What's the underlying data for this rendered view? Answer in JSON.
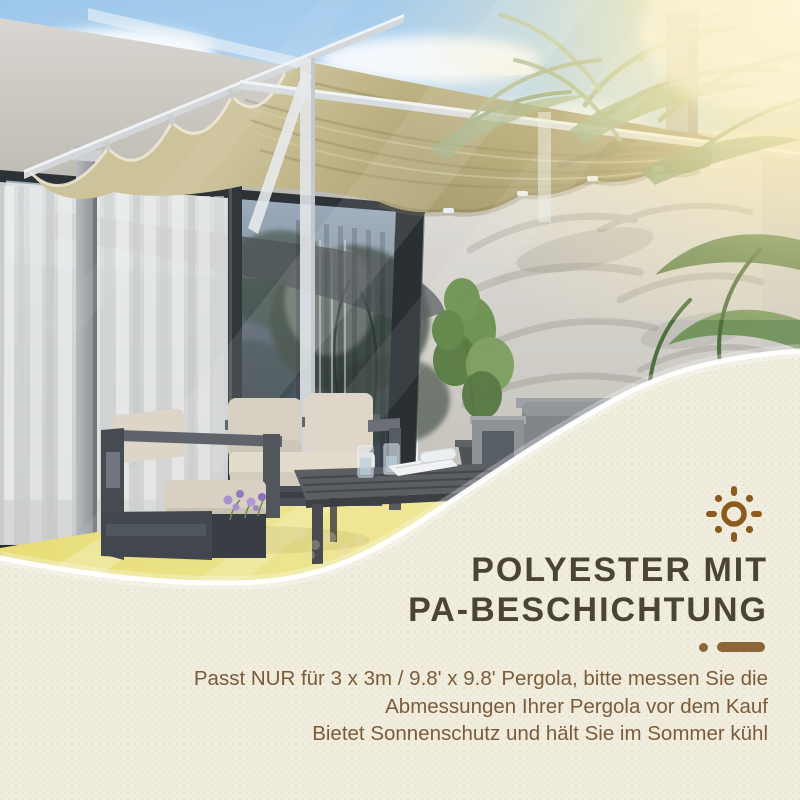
{
  "info_panel": {
    "sun_icon": "sun-icon",
    "heading_lines": [
      "POLYESTER MIT",
      "PA-BESCHICHTUNG"
    ],
    "body_lines": [
      "Passt NUR für 3 x 3m / 9.8' x 9.8' Pergola, bitte messen Sie die",
      "Abmessungen Ihrer Pergola vor dem Kauf",
      "Bietet Sonnenschutz und hält Sie im Sommer kühl"
    ],
    "colors": {
      "panel_bg": "#f0edde",
      "heading": "#4a4435",
      "body": "#7c5b39",
      "accent_brown": "#8a5a1e",
      "divider": "#8a6638"
    }
  },
  "photo": {
    "subject": "pergola-retractable-canopy-patio",
    "palette": {
      "sky": "#9cc7ea",
      "canopy_beige": "#b6ab7c",
      "wall_gray": "#d4d1cb",
      "glass": "#4e5a66",
      "floor_glow": "#eae081",
      "furniture_frame": "#4c5158",
      "cushion": "#dbd4c6",
      "palm_green": "#6d8d55"
    }
  }
}
